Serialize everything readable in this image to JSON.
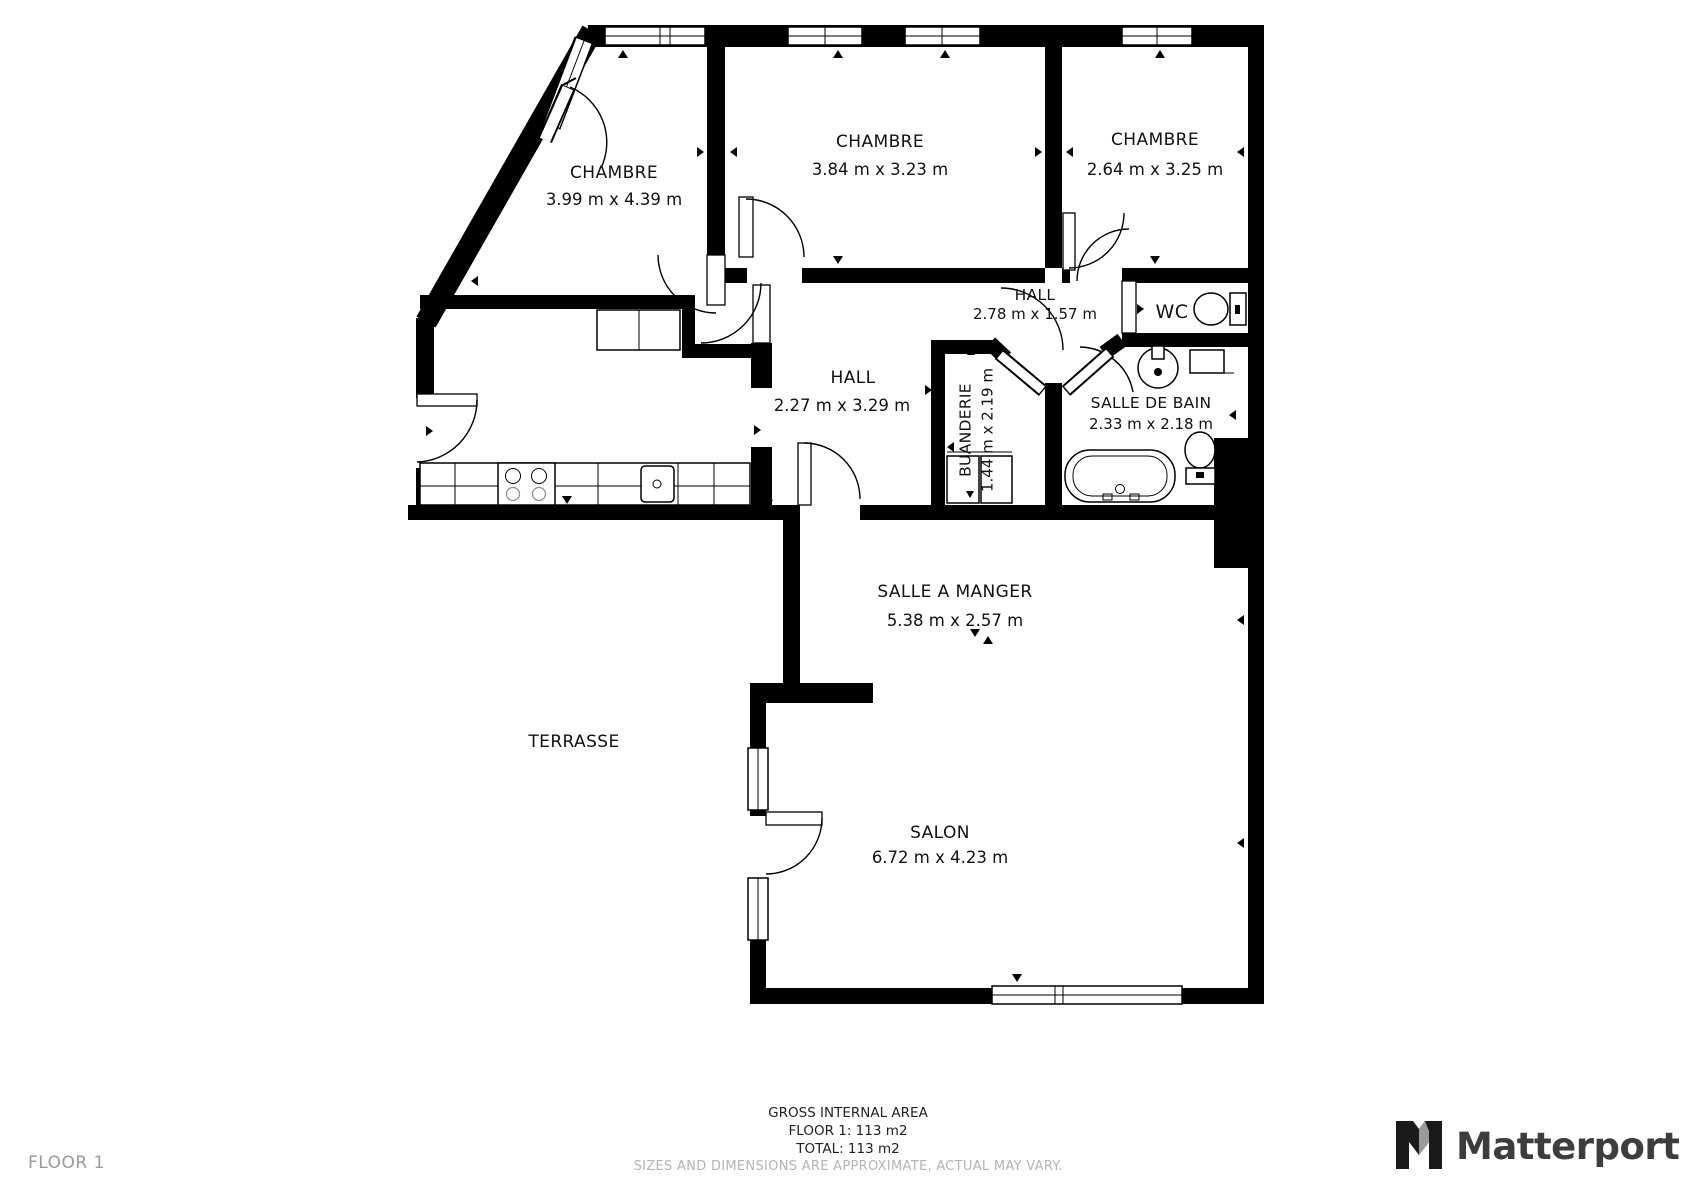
{
  "plan": {
    "rooms": [
      {
        "name": "CHAMBRE",
        "dims": "3.99 m x 4.39 m"
      },
      {
        "name": "CHAMBRE",
        "dims": "3.84 m x 3.23 m"
      },
      {
        "name": "CHAMBRE",
        "dims": "2.64 m x 3.25 m"
      },
      {
        "name": "HALL",
        "dims": "2.78 m x 1.57 m"
      },
      {
        "name": "WC",
        "dims": ""
      },
      {
        "name": "HALL",
        "dims": "2.27 m x 3.29 m"
      },
      {
        "name": "BUANDERIE",
        "dims": "1.44 m x 2.19 m"
      },
      {
        "name": "SALLE DE BAIN",
        "dims": "2.33 m x 2.18 m"
      },
      {
        "name": "SALLE A MANGER",
        "dims": "5.38 m x 2.57 m"
      },
      {
        "name": "TERRASSE",
        "dims": ""
      },
      {
        "name": "SALON",
        "dims": "6.72 m x 4.23 m"
      }
    ],
    "footer": {
      "title": "GROSS INTERNAL AREA",
      "floor_area": "FLOOR 1: 113 m2",
      "total_area": "TOTAL: 113 m2",
      "disclaimer": "SIZES AND DIMENSIONS ARE APPROXIMATE, ACTUAL MAY VARY."
    },
    "floor_label": "FLOOR 1",
    "branding": {
      "logo_text": "Matterport"
    },
    "colors": {
      "wall": "#000000",
      "text": "#111111",
      "muted_text": "#9a9a9a",
      "disclaimer_text": "#b4b4b4",
      "logo_text": "#3d3d3d"
    }
  }
}
